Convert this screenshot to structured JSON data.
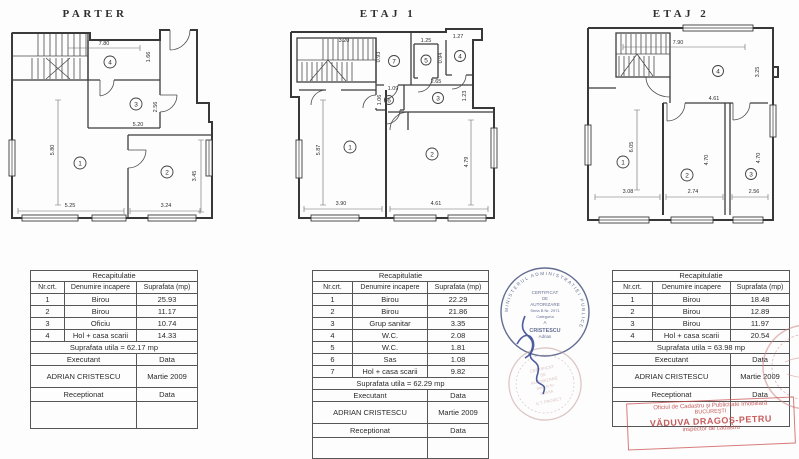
{
  "page": {
    "background": "#fdfdfd",
    "ink": "#2f2f2f",
    "stamp_blue": "#3d4a78",
    "stamp_red": "#c14b4b"
  },
  "plans": [
    {
      "title": "PARTER",
      "rooms": [
        "1",
        "2",
        "3",
        "4"
      ],
      "dims": [
        "7.80",
        "1.66",
        "2.56",
        "5.20",
        "5.80",
        "5.25",
        "3.24",
        "3.45"
      ]
    },
    {
      "title": "ETAJ 1",
      "rooms": [
        "1",
        "2",
        "3",
        "4",
        "5",
        "6",
        "7"
      ],
      "dims": [
        "3.20",
        "0.93",
        "1.25",
        "1.27",
        "0.94",
        "2.65",
        "1.09",
        "1.06",
        "1.23",
        "5.87",
        "4.79",
        "3.90",
        "4.61"
      ]
    },
    {
      "title": "ETAJ 2",
      "rooms": [
        "1",
        "2",
        "3",
        "4"
      ],
      "dims": [
        "7.90",
        "3.25",
        "4.61",
        "6.05",
        "4.70",
        "4.70",
        "3.08",
        "2.74",
        "2.56"
      ]
    }
  ],
  "tables": [
    {
      "title": "Recapitulatie",
      "columns": [
        "Nr.crt.",
        "Denumire incapere",
        "Suprafata (mp)"
      ],
      "rows": [
        {
          "nr": "1",
          "name": "Birou",
          "area": "25.93"
        },
        {
          "nr": "2",
          "name": "Birou",
          "area": "11.17"
        },
        {
          "nr": "3",
          "name": "Oficiu",
          "area": "10.74"
        },
        {
          "nr": "4",
          "name": "Hol + casa scarii",
          "area": "14.33"
        }
      ],
      "total": "Suprafata utila = 62.17 mp",
      "executant": "Executant",
      "data1": "Data",
      "name": "ADRIAN CRISTESCU",
      "date": "Martie 2009",
      "receptionat": "Receptionat",
      "data2": "Data"
    },
    {
      "title": "Recapitulatie",
      "columns": [
        "Nr.crt.",
        "Denumire incapere",
        "Suprafata (mp)"
      ],
      "rows": [
        {
          "nr": "1",
          "name": "Birou",
          "area": "22.29"
        },
        {
          "nr": "2",
          "name": "Birou",
          "area": "21.86"
        },
        {
          "nr": "3",
          "name": "Grup sanitar",
          "area": "3.35"
        },
        {
          "nr": "4",
          "name": "W.C.",
          "area": "2.08"
        },
        {
          "nr": "5",
          "name": "W.C.",
          "area": "1.81"
        },
        {
          "nr": "6",
          "name": "Sas",
          "area": "1.08"
        },
        {
          "nr": "7",
          "name": "Hol + casa scarii",
          "area": "9.82"
        }
      ],
      "total": "Suprafata utila = 62.29 mp",
      "executant": "Executant",
      "data1": "Data",
      "name": "ADRIAN CRISTESCU",
      "date": "Martie 2009",
      "receptionat": "Receptionat",
      "data2": "Data"
    },
    {
      "title": "Recapitulatie",
      "columns": [
        "Nr.crt.",
        "Denumire incapere",
        "Suprafata (mp)"
      ],
      "rows": [
        {
          "nr": "1",
          "name": "Birou",
          "area": "18.48"
        },
        {
          "nr": "2",
          "name": "Birou",
          "area": "12.89"
        },
        {
          "nr": "3",
          "name": "Birou",
          "area": "11.97"
        },
        {
          "nr": "4",
          "name": "Hol + casa scarii",
          "area": "20.54"
        }
      ],
      "total": "Suprafata utila = 63.98 mp",
      "executant": "Executant",
      "data1": "Data",
      "name": "ADRIAN CRISTESCU",
      "date": "Martie 2009",
      "receptionat": "Receptionat",
      "data2": "Data"
    }
  ],
  "stamps": {
    "certificate": {
      "ring": "MINISTERUL ADMINISTRATIEI PUBLICE",
      "l1": "CERTIFICAT",
      "l2": "DE",
      "l3": "AUTORIZARE",
      "l4": "Seria B Nr. 2971",
      "l5": "Categoria",
      "l6": "A",
      "l7": "CRISTESCU",
      "l8": "Adrian"
    },
    "certificate2": {
      "l1": "CERTIFICAT",
      "l2": "DE",
      "l3": "AUTORIZARE",
      "l4": "Seria B Nr.",
      "l5": "CLASA",
      "l6": "G.T. PROIECT"
    },
    "cadastru": {
      "l1": "Oficiul de Cadastru şi Publicitate Imobiliară",
      "l2": "BUCUREŞTI",
      "l3": "VĂDUVA DRAGOŞ-PETRU",
      "l4": "inspector de cadastru"
    }
  }
}
